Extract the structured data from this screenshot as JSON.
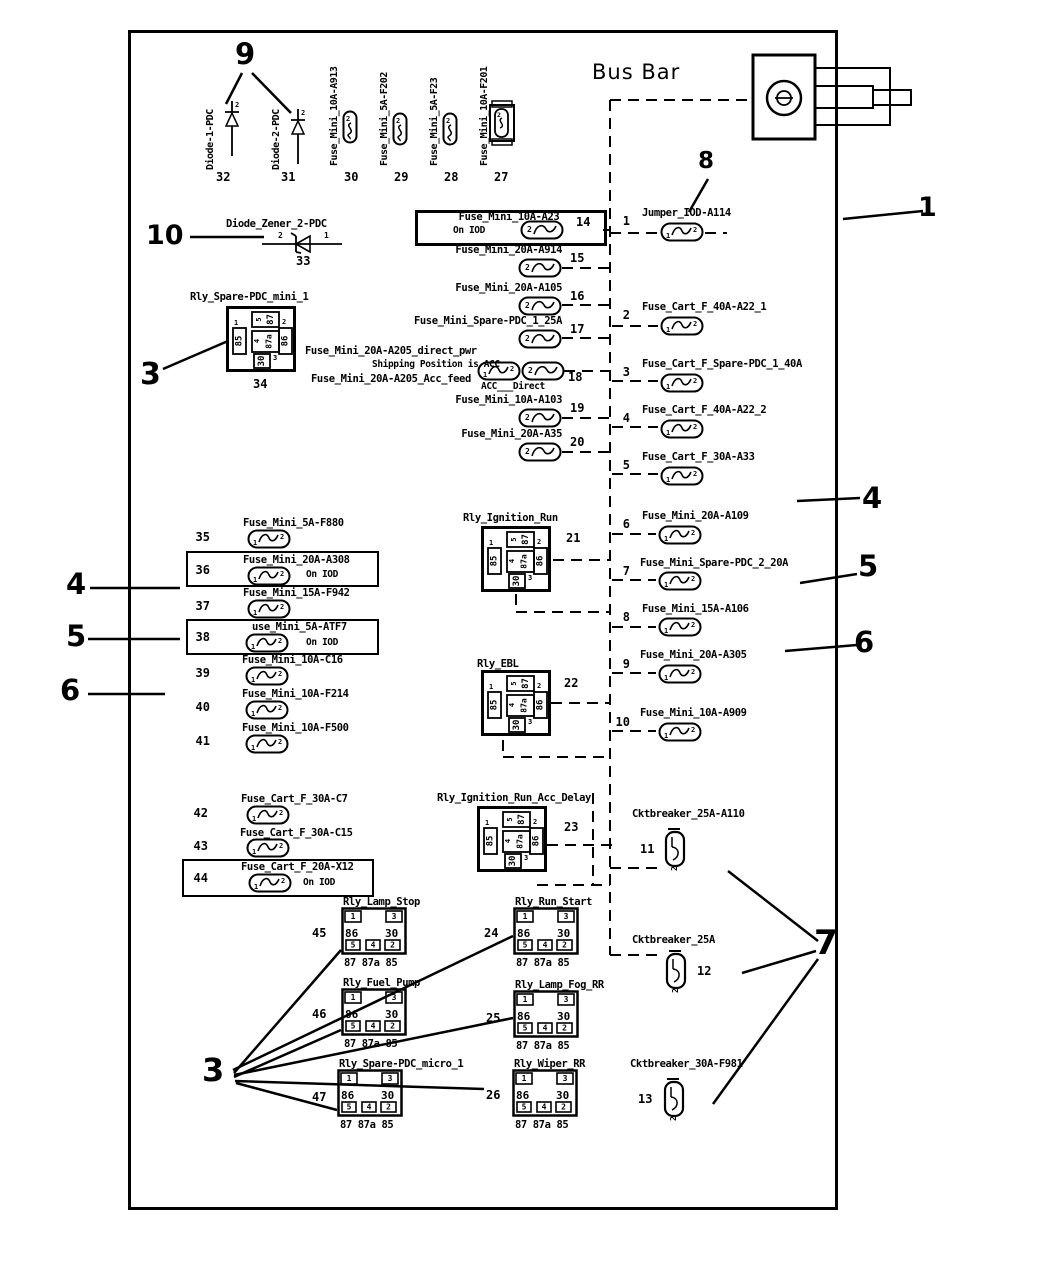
{
  "header": {
    "bus_bar_label": "Bus Bar"
  },
  "callouts": {
    "c9": "9",
    "c10": "10",
    "c3_top": "3",
    "c4_left": "4",
    "c5_left": "5",
    "c6_left": "6",
    "c1": "1",
    "c8": "8",
    "c4_right": "4",
    "c5_right": "5",
    "c6_right": "6",
    "c7": "7",
    "c3_bottom": "3"
  },
  "top_fuses": [
    {
      "num": "32",
      "label": "Diode-1-PDC"
    },
    {
      "num": "31",
      "label": "Diode-2-PDC"
    },
    {
      "num": "30",
      "label": "Fuse_Mini_10A-A913"
    },
    {
      "num": "29",
      "label": "Fuse_Mini_5A-F202"
    },
    {
      "num": "28",
      "label": "Fuse_Mini_5A-F23"
    },
    {
      "num": "27",
      "label": "Fuse_Mini_10A-F201"
    }
  ],
  "zener": {
    "num": "33",
    "label": "Diode_Zener_2-PDC",
    "pin_left": "2",
    "pin_right": "1"
  },
  "middle_fuses": [
    {
      "num": "14",
      "label": "Fuse_Mini_10A-A23",
      "note": "On IOD"
    },
    {
      "num": "15",
      "label": "Fuse_Mini_20A-A914"
    },
    {
      "num": "16",
      "label": "Fuse_Mini_20A-A105"
    },
    {
      "num": "17",
      "label": "Fuse_Mini_Spare-PDC_1_25A"
    },
    {
      "num": "18",
      "label": "Fuse_Mini_20A-A205_direct_pwr",
      "label2": "Shipping Position is ACC",
      "label3": "Fuse_Mini_20A-A205_Acc_feed",
      "sub": "ACC___Direct"
    },
    {
      "num": "19",
      "label": "Fuse_Mini_10A-A103"
    },
    {
      "num": "20",
      "label": "Fuse_Mini_20A-A35"
    }
  ],
  "right_items": [
    {
      "num": "1",
      "label": "Jumper_IOD-A114"
    },
    {
      "num": "2",
      "label": "Fuse_Cart_F_40A-A22_1"
    },
    {
      "num": "3",
      "label": "Fuse_Cart_F_Spare-PDC_1_40A"
    },
    {
      "num": "4",
      "label": "Fuse_Cart_F_40A-A22_2"
    },
    {
      "num": "5",
      "label": "Fuse_Cart_F_30A-A33"
    },
    {
      "num": "6",
      "label": "Fuse_Mini_20A-A109"
    },
    {
      "num": "7",
      "label": "Fuse_Mini_Spare-PDC_2_20A"
    },
    {
      "num": "8",
      "label": "Fuse_Mini_15A-A106"
    },
    {
      "num": "9",
      "label": "Fuse_Mini_20A-A305"
    },
    {
      "num": "10",
      "label": "Fuse_Mini_10A-A909"
    }
  ],
  "breakers": [
    {
      "num": "11",
      "label": "Cktbreaker_25A-A110"
    },
    {
      "num": "12",
      "label": "Cktbreaker_25A"
    },
    {
      "num": "13",
      "label": "Cktbreaker_30A-F981"
    }
  ],
  "left_fuses": [
    {
      "num": "35",
      "label": "Fuse_Mini_5A-F880"
    },
    {
      "num": "36",
      "label": "Fuse_Mini_20A-A308",
      "note": "On IOD"
    },
    {
      "num": "37",
      "label": "Fuse_Mini_15A-F942"
    },
    {
      "num": "38",
      "label": "use_Mini_5A-ATF7",
      "note": "On IOD"
    },
    {
      "num": "39",
      "label": "Fuse_Mini_10A-C16"
    },
    {
      "num": "40",
      "label": "Fuse_Mini_10A-F214"
    },
    {
      "num": "41",
      "label": "Fuse_Mini_10A-F500"
    },
    {
      "num": "42",
      "label": "Fuse_Cart_F_30A-C7"
    },
    {
      "num": "43",
      "label": "Fuse_Cart_F_30A-C15"
    },
    {
      "num": "44",
      "label": "Fuse_Cart_F_20A-X12",
      "note": "On IOD"
    }
  ],
  "large_relays": [
    {
      "num": "34",
      "label": "Rly_Spare-PDC_mini_1"
    },
    {
      "num": "21",
      "label": "Rly_Ignition_Run"
    },
    {
      "num": "22",
      "label": "Rly_EBL"
    },
    {
      "num": "23",
      "label": "Rly_Ignition_Run_Acc_Delay"
    }
  ],
  "micro_relays": [
    {
      "num": "45",
      "label": "Rly_Lamp_Stop"
    },
    {
      "num": "24",
      "label": "Rly_Run_Start"
    },
    {
      "num": "46",
      "label": "Rly_Fuel_Pump"
    },
    {
      "num": "25",
      "label": "Rly_Lamp_Fog_RR"
    },
    {
      "num": "47",
      "label": "Rly_Spare-PDC_micro_1"
    },
    {
      "num": "26",
      "label": "Rly_Wiper_RR"
    }
  ],
  "icons": {
    "fuse_mini": {
      "n2": "2"
    },
    "fuse_cart": {
      "n1": "1",
      "n2": "2"
    },
    "breaker": {
      "n2": "2"
    },
    "diode": {
      "n2": "2"
    },
    "relay_large": {
      "t85": "85",
      "t86": "86",
      "t87": "87",
      "t87a": "87a",
      "t30": "30",
      "n1": "1",
      "n2": "2",
      "n3": "3",
      "n4": "4",
      "n5": "5"
    },
    "relay_micro": {
      "s1": "1",
      "s3": "3",
      "l86": "86",
      "l30": "30",
      "s5": "5",
      "s4": "4",
      "s2": "2",
      "caption": "87 87a 85"
    }
  }
}
